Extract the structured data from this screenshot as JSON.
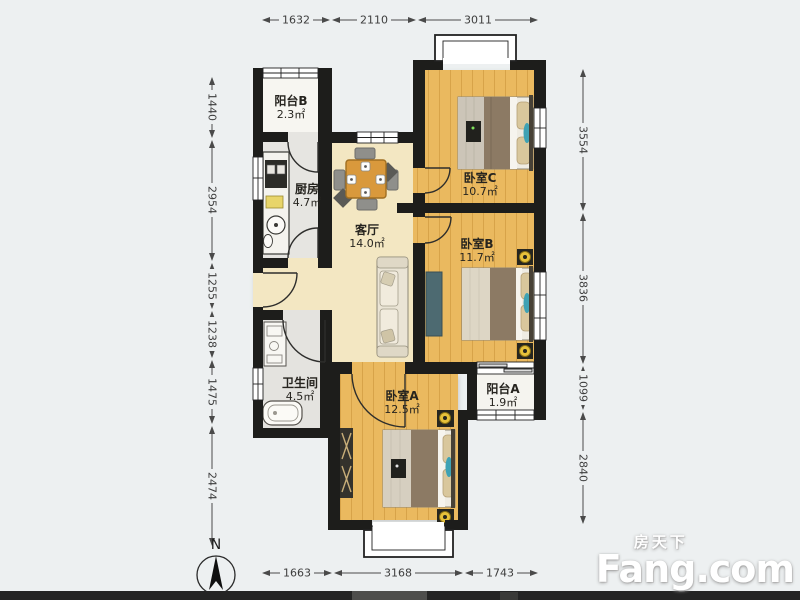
{
  "floor_plan": {
    "rooms": [
      {
        "name": "阳台B",
        "area": "2.3㎡"
      },
      {
        "name": "厨房",
        "area": "4.7㎡"
      },
      {
        "name": "客厅",
        "area": "14.0㎡"
      },
      {
        "name": "卧室C",
        "area": "10.7㎡"
      },
      {
        "name": "卧室B",
        "area": "11.7㎡"
      },
      {
        "name": "卫生间",
        "area": "4.5㎡"
      },
      {
        "name": "卧室A",
        "area": "12.5㎡"
      },
      {
        "name": "阳台A",
        "area": "1.9㎡"
      }
    ],
    "dimensions": {
      "top": [
        "1632",
        "2110",
        "3011"
      ],
      "bottom": [
        "1663",
        "3168",
        "1743"
      ],
      "left": [
        "1440",
        "2954",
        "1255",
        "1238",
        "1475",
        "2474"
      ],
      "right": [
        "3554",
        "3836",
        "1099",
        "2840"
      ]
    },
    "compass": {
      "label": "N"
    },
    "watermark": {
      "brand_cn": "房天下",
      "brand_en": "Fang.com"
    },
    "colors": {
      "wall": "#1d1d1b",
      "wood_floor": "#eab95f",
      "living_floor": "#f3e7c2",
      "service_floor": "#e6e5e1",
      "balcony_floor": "#f7f6f1",
      "accent_teal": "#3fa2b4",
      "accent_lamp": "#e6c13a",
      "brand_text": "#ffffff"
    }
  }
}
